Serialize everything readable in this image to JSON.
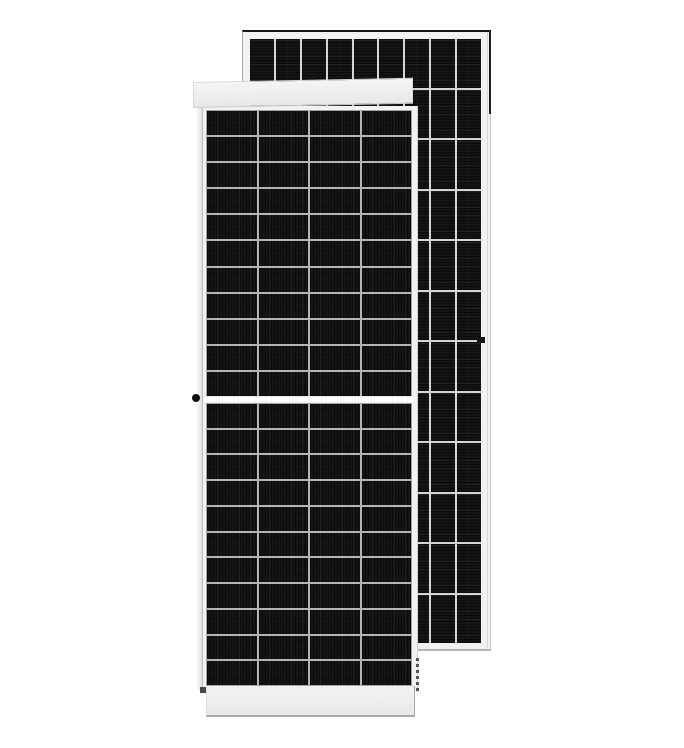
{
  "image_type": "product-render",
  "subject": "two framed solar panels overlapping on a white background, front face in front and rear face behind",
  "front_panel": {
    "view": "front",
    "cell_columns": 4,
    "cell_rows_per_half": 11,
    "halves": 2,
    "features": [
      "white frame",
      "top rail band",
      "bottom rail band",
      "horizontal center divider",
      "grounding dot on left frame",
      "dark corner mark bottom-left",
      "dashed frame shadow lower-right"
    ]
  },
  "back_panel": {
    "view": "rear",
    "cell_columns": 9,
    "cell_rows": 12,
    "features": [
      "dark top edge",
      "dark upper-right edge",
      "white frame",
      "small mounting mark on right edge"
    ]
  },
  "colors": {
    "background": "#ffffff",
    "cell_dark": "#141417",
    "cell_stripe_dark": "#0b0b0d",
    "front_grid_line": "#b2b6b6",
    "back_grid_line": "#d4d6d6",
    "frame_light": "#f2f2f3",
    "rail_light": "#eeeeef",
    "dark_edge": "#161616"
  }
}
